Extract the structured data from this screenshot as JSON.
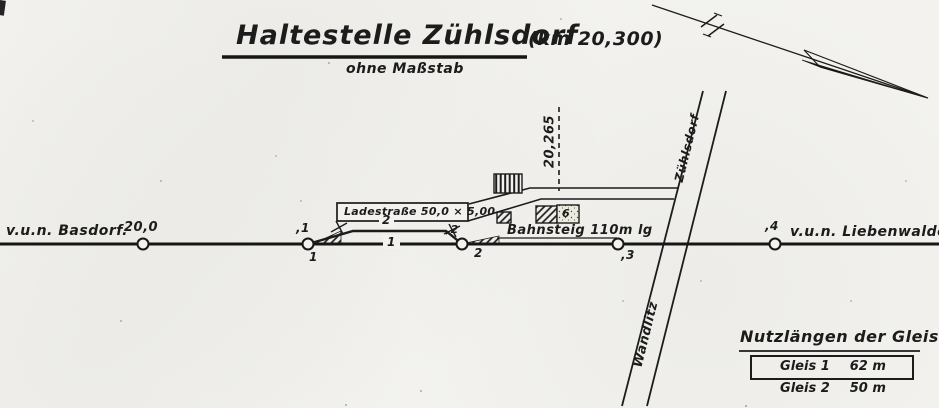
{
  "title": {
    "main": "Haltestelle Zühlsdorf",
    "km": "(km 20,300)",
    "subtitle": "ohne Maßstab"
  },
  "endpoints": {
    "left": "v.u.n. Basdorf.",
    "right": "v.u.n. Liebenwalde"
  },
  "km_markers": {
    "m0": "20,0",
    "m1": ",1",
    "m2": ",2",
    "m3": ",3",
    "m4": ",4",
    "center_line": "20,265"
  },
  "switches": {
    "s1": "1",
    "s2": "2"
  },
  "tracks": {
    "main_number": "1",
    "siding_number": "2"
  },
  "features": {
    "loading_road": "Ladestraße 50,0 × 5,00",
    "platform": "Bahnsteig 110m lg",
    "building_number": "6"
  },
  "roads": {
    "north": "Zühlsdorf",
    "south": "Wandlitz"
  },
  "table": {
    "heading": "Nutzlängen der Gleise",
    "rows": [
      {
        "name": "Gleis 1",
        "length": "62 m"
      },
      {
        "name": "Gleis 2",
        "length": "50 m"
      }
    ]
  },
  "colors": {
    "paper": "#f3f2ee",
    "ink": "#1c1c1c"
  }
}
